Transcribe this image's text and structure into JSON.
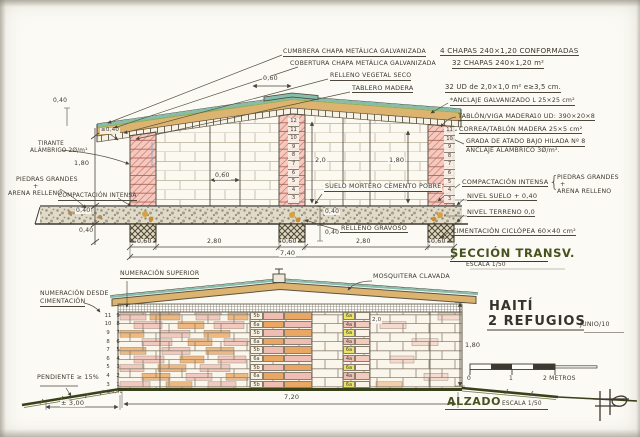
{
  "paper_color": "#fbfaf4",
  "ink_color": "#3e3930",
  "accent_green": "#47521f",
  "section": {
    "title": "SECCIÓN TRANSV.",
    "scale_label": "ESCALA 1/50",
    "notes": {
      "cumbrera": "CUMBRERA CHAPA METÁLICA GALVANIZADA",
      "cumbrera_val": "4 CHAPAS 240×1,20 CONFORMADAS",
      "cobertura": "COBERTURA CHAPA METÁLICA GALVANIZADA",
      "cobertura_val": "32 CHAPAS 240×1,20 m²",
      "relleno_vegetal": "RELLENO VEGETAL SECO",
      "tablero": "TABLERO MADERA",
      "tablero_val": "32 UD de 2,0×1,0 m²  e≥3,5 cm.",
      "anclaje": "*ANCLAJE GALVANIZADO L 25×25 cm²",
      "tablon": "TABLÓN/VIGA MADERA",
      "tablon_val": "10 UD: 390×20×8",
      "correa": "CORREA/TABLÓN MADERA 25×5 cm²",
      "grada": "GRADA DE ATADO BAJO HILADA Nº 8",
      "grada2": "ANCLAJE ALÁMBRICO 3Ø/m².",
      "compactacion": "COMPACTACIÓN INTENSA",
      "brace": "{",
      "piedras1": "PIEDRAS GRANDES",
      "piedras_plus": "+",
      "piedras2": "ARENA RELLENO",
      "nivel_suelo": "NIVEL SUELO + 0,40",
      "nivel_terreno": "NIVEL TERRENO 0,0",
      "cimentacion": "CIMENTACIÓN CICLÓPEA 60×40 cm²",
      "tirante1": "TIRANTE",
      "tirante2": "ALÁMBRICO 2Ø/m¹",
      "piedras_left1": "PIEDRAS GRANDES",
      "piedras_left_plus": "+",
      "piedras_left2": "ARENA RELLENO",
      "compactacion_left": "COMPACTACIÓN INTENSA",
      "suelo_mortero": "SUELO MORTERO CEMENTO POBRE",
      "relleno_gravoso": "RELLENO GRAVOSO"
    },
    "dims": {
      "ridge_overlap": "0,60",
      "eave_left": "≥0,40",
      "chain_top": "0,40",
      "wall_height": "1,80",
      "band_height": "0,40",
      "footing_height": "0,40",
      "door_width": "0,60",
      "room_height_left": "2,0",
      "room_height_right": "1,80",
      "floor_band": "0,40",
      "footing_right": "0,40",
      "b1": "0,60",
      "b2": "2,80",
      "b3": "0,60",
      "b4": "2,80",
      "b5": "0,60",
      "total_width": "7,40"
    },
    "hiladas_mid": [
      {
        "n": "12"
      },
      {
        "n": "11"
      },
      {
        "n": "10"
      },
      {
        "n": "9"
      },
      {
        "n": "8"
      },
      {
        "n": "7"
      },
      {
        "n": "6"
      },
      {
        "n": "5"
      },
      {
        "n": "4"
      },
      {
        "n": "3"
      }
    ],
    "hiladas_right": [
      {
        "n": "11"
      },
      {
        "n": "10"
      },
      {
        "n": "9"
      },
      {
        "n": "8"
      },
      {
        "n": "7"
      },
      {
        "n": "6"
      },
      {
        "n": "5"
      },
      {
        "n": "4"
      },
      {
        "n": "3"
      }
    ]
  },
  "elevation": {
    "title": "ALZADO",
    "scale_label": "ESCALA 1/50",
    "project_line1": "HAITÍ",
    "project_line2": "2 REFUGIOS",
    "date": "JUNIO/10",
    "numeracion_superior": "NUMERACIÓN SUPERIOR",
    "numeracion_desde1": "NUMERACIÓN DESDE",
    "numeracion_desde2": "CIMENTACIÓN",
    "mosquitera": "MOSQUITERA CLAVADA",
    "pendiente": "PENDIENTE ≥ 15%",
    "dim_slope": "± 3,00",
    "dim_base": "±0,40",
    "dim_width": "7,20",
    "dim_height": "1,80",
    "block_dim": "2,0",
    "scalebar": {
      "zero": "0",
      "one": "1",
      "two": "2 METROS"
    },
    "numbering": [
      {
        "l": "11",
        "r": "9"
      },
      {
        "l": "10",
        "r": "8"
      },
      {
        "l": "9",
        "r": "7"
      },
      {
        "l": "8",
        "r": "6"
      },
      {
        "l": "7",
        "r": "5"
      },
      {
        "l": "6",
        "r": "4"
      },
      {
        "l": "5",
        "r": "3"
      },
      {
        "l": "4",
        "r": "2"
      },
      {
        "l": "3",
        "r": "1"
      }
    ],
    "center_blocks": [
      {
        "t": "5b"
      },
      {
        "t": "6a"
      },
      {
        "t": "5b"
      },
      {
        "t": "6a"
      },
      {
        "t": "5b"
      },
      {
        "t": "6a"
      },
      {
        "t": "5b"
      },
      {
        "t": "6a"
      },
      {
        "t": "5b"
      }
    ],
    "right_blocks": [
      {
        "t": "6a"
      },
      {
        "t": "4a"
      },
      {
        "t": "6a"
      },
      {
        "t": "4a"
      },
      {
        "t": "6a"
      },
      {
        "t": "4a"
      },
      {
        "t": "6a"
      },
      {
        "t": "4a"
      },
      {
        "t": "6a"
      }
    ]
  }
}
